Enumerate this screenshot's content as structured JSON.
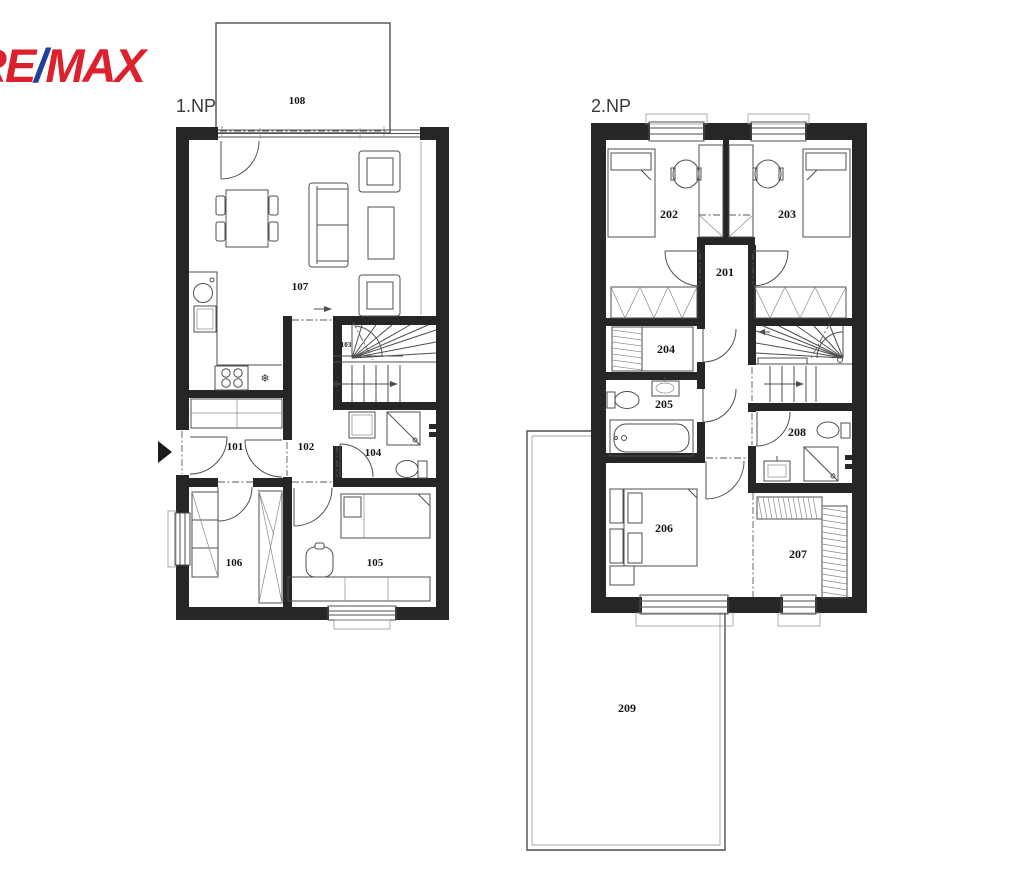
{
  "logo": {
    "re": "RE",
    "slash": "/",
    "max": "MAX"
  },
  "floor1": {
    "label": "1.NP",
    "rooms": {
      "r101": "101",
      "r102": "102",
      "r103": "103",
      "r104": "104",
      "r105": "105",
      "r106": "106",
      "r107": "107",
      "r108": "108"
    }
  },
  "floor2": {
    "label": "2.NP",
    "rooms": {
      "r201": "201",
      "r202": "202",
      "r203": "203",
      "r204": "204",
      "r205": "205",
      "r206": "206",
      "r207": "207",
      "r208": "208",
      "r209": "209"
    }
  },
  "icons": {
    "fridge": "❄"
  }
}
